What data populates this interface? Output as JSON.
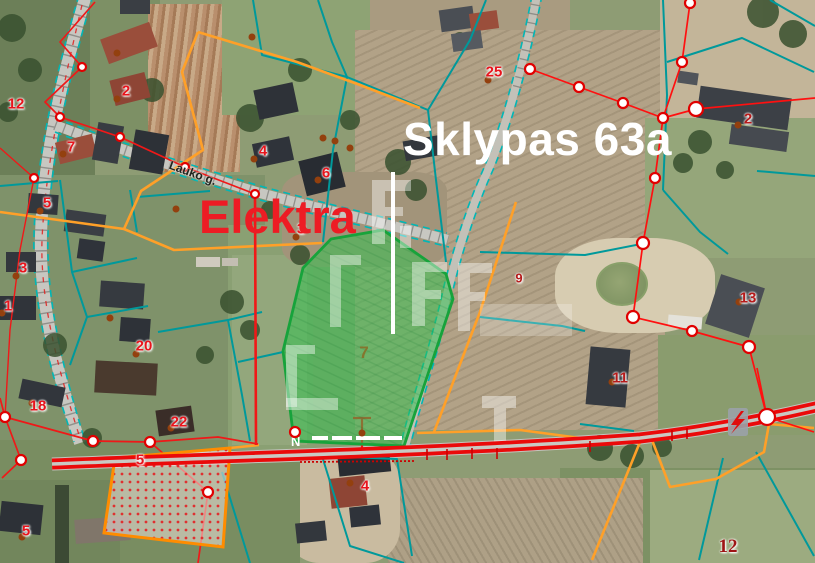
{
  "view": {
    "type": "cadastral-map",
    "width": 815,
    "height": 563
  },
  "labels": {
    "headline": "Sklypas 63a",
    "annotation": "Elektra",
    "street_top": "Lauko g.",
    "street_bottom_fragment": "N"
  },
  "legend_colors": {
    "parcel_boundary_teal": "#00999b",
    "parcel_boundary_orange": "#ffa028",
    "boundary_red": "#f01818",
    "power_line_red": "#ff1010",
    "highlight_parcel_green": "#2fc24f",
    "road_highlight_red": "#ea0a0a",
    "headline_white": "#ffffff",
    "annotation_red": "#ed1c24"
  },
  "icons": {
    "transformer": "lightning-bolt-icon",
    "survey_node": "circle-node-marker",
    "boundary_point": "brown-dot-marker"
  },
  "map": {
    "highlighted_parcel_number": "7",
    "parcel_numbers": [
      {
        "label": "12",
        "x": 16,
        "y": 104,
        "style": "bright"
      },
      {
        "label": "2",
        "x": 126,
        "y": 91,
        "style": "bright"
      },
      {
        "label": "7",
        "x": 71,
        "y": 147,
        "style": "bright"
      },
      {
        "label": "4",
        "x": 263,
        "y": 151,
        "style": "bright"
      },
      {
        "label": "6",
        "x": 326,
        "y": 173,
        "style": "bright"
      },
      {
        "label": "25",
        "x": 494,
        "y": 72,
        "style": "bright"
      },
      {
        "label": "2",
        "x": 748,
        "y": 119,
        "style": "dark"
      },
      {
        "label": "3",
        "x": 301,
        "y": 229,
        "style": "bright"
      },
      {
        "label": "5",
        "x": 47,
        "y": 203,
        "style": "bright"
      },
      {
        "label": "3",
        "x": 23,
        "y": 268,
        "style": "bright"
      },
      {
        "label": "1",
        "x": 8,
        "y": 306,
        "style": "bright"
      },
      {
        "label": "20",
        "x": 144,
        "y": 346,
        "style": "bright"
      },
      {
        "label": "9",
        "x": 519,
        "y": 278,
        "style": "small-dark"
      },
      {
        "label": "13",
        "x": 748,
        "y": 298,
        "style": "dark"
      },
      {
        "label": "11",
        "x": 620,
        "y": 378,
        "style": "dark"
      },
      {
        "label": "18",
        "x": 38,
        "y": 406,
        "style": "bright"
      },
      {
        "label": "22",
        "x": 179,
        "y": 422,
        "style": "bright"
      },
      {
        "label": "5",
        "x": 140,
        "y": 460,
        "style": "bright"
      },
      {
        "label": "7",
        "x": 364,
        "y": 353,
        "style": "olive"
      },
      {
        "label": "4",
        "x": 365,
        "y": 486,
        "style": "bright"
      },
      {
        "label": "5",
        "x": 26,
        "y": 531,
        "style": "bright"
      },
      {
        "label": "12",
        "x": 728,
        "y": 547,
        "style": "serif"
      }
    ],
    "survey_nodes": [
      [
        82,
        67,
        4
      ],
      [
        60,
        117,
        4
      ],
      [
        120,
        137,
        4
      ],
      [
        185,
        167,
        4
      ],
      [
        255,
        194,
        4
      ],
      [
        34,
        178,
        4
      ],
      [
        5,
        417,
        5
      ],
      [
        21,
        460,
        5
      ],
      [
        93,
        441,
        5
      ],
      [
        150,
        442,
        5
      ],
      [
        208,
        492,
        5
      ],
      [
        530,
        69,
        5
      ],
      [
        579,
        87,
        5
      ],
      [
        623,
        103,
        5
      ],
      [
        663,
        118,
        5
      ],
      [
        682,
        62,
        5
      ],
      [
        690,
        3,
        5
      ],
      [
        696,
        109,
        7
      ],
      [
        655,
        178,
        5
      ],
      [
        643,
        243,
        6
      ],
      [
        633,
        317,
        6
      ],
      [
        692,
        331,
        5
      ],
      [
        749,
        347,
        6
      ],
      [
        767,
        417,
        8
      ],
      [
        295,
        432,
        5
      ]
    ],
    "boundary_dots": [
      [
        488,
        80
      ],
      [
        117,
        99
      ],
      [
        117,
        53
      ],
      [
        63,
        154
      ],
      [
        254,
        159
      ],
      [
        318,
        180
      ],
      [
        296,
        237
      ],
      [
        40,
        211
      ],
      [
        16,
        276
      ],
      [
        2,
        313
      ],
      [
        136,
        354
      ],
      [
        739,
        302
      ],
      [
        612,
        382
      ],
      [
        171,
        428
      ],
      [
        32,
        403
      ],
      [
        22,
        537
      ],
      [
        350,
        483
      ],
      [
        738,
        125
      ],
      [
        323,
        138
      ],
      [
        335,
        141
      ],
      [
        350,
        148
      ],
      [
        252,
        37
      ],
      [
        110,
        318
      ],
      [
        176,
        209
      ],
      [
        362,
        433
      ]
    ]
  }
}
